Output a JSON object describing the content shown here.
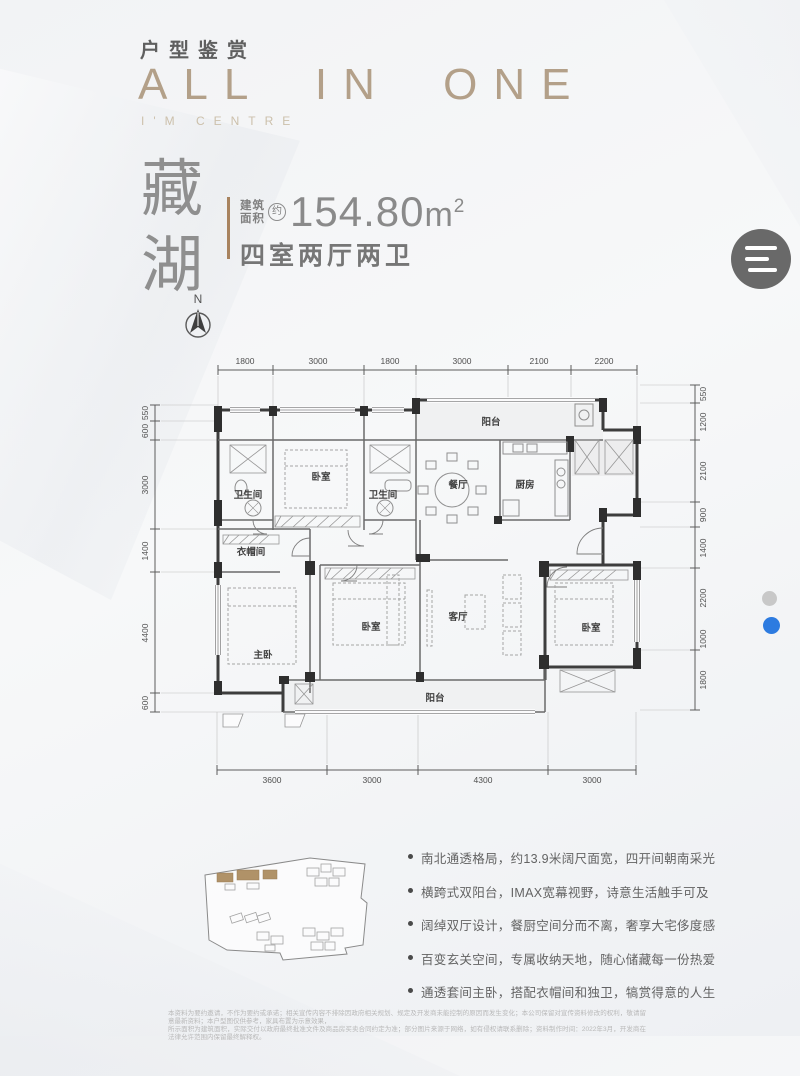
{
  "header": {
    "category": "户型鉴赏",
    "title": "ALL IN ONE",
    "subtitle": "I'M CENTRE"
  },
  "unit": {
    "name_char_1": "藏",
    "name_char_2": "湖",
    "compass_label": "N",
    "area_prefix_line1": "建筑",
    "area_prefix_line2": "面积",
    "area_approx": "约",
    "area_value": "154.80",
    "area_unit": "m",
    "area_exponent": "2",
    "layout_type": "四室两厅两卫"
  },
  "menu_button": {
    "icon": "hamburger-menu"
  },
  "pagination": {
    "dots": [
      {
        "state": "inactive",
        "color": "#c8c8c8"
      },
      {
        "state": "active",
        "color": "#2d7be0"
      }
    ]
  },
  "floor_plan": {
    "dims_top": [
      "1800",
      "3000",
      "1800",
      "3000",
      "2100",
      "2200"
    ],
    "dims_left": [
      "550",
      "600",
      "3000",
      "1400",
      "4400",
      "600"
    ],
    "dims_right": [
      "550",
      "1200",
      "2100",
      "900",
      "1400",
      "2200",
      "1000",
      "1800"
    ],
    "dims_bottom": [
      "3600",
      "3000",
      "4300",
      "3000"
    ],
    "rooms": {
      "bathroom1": "卫生间",
      "bedroom_top": "卧室",
      "bathroom2": "卫生间",
      "dining": "餐厅",
      "kitchen": "厨房",
      "balcony_top": "阳台",
      "cloakroom": "衣帽间",
      "master": "主卧",
      "bedroom_center": "卧室",
      "living": "客厅",
      "bedroom_right": "卧室",
      "balcony_bottom": "阳台"
    }
  },
  "site_plan": {
    "highlight_color": "#b09268"
  },
  "features": [
    "南北通透格局，约13.9米阔尺面宽，四开间朝南采光",
    "横跨式双阳台，IMAX宽幕视野，诗意生活触手可及",
    "阔绰双厅设计，餐厨空间分而不离，奢享大宅侈度感",
    "百变玄关空间，专属收纳天地，随心储藏每一份热爱",
    "通透套间主卧，搭配衣帽间和独卫，犒赏得意的人生"
  ],
  "disclaimer_line1": "本资料为要约邀请，不作为要约或承诺；相关宣传内容不排除因政府相关规划、规定及开发商未能控制的原因而发生变化；本公司保留对宣传资料修改的权利，敬请留意最新资料；本户型图仅供参考，家具布置为示意效果，",
  "disclaimer_line2": "所示面积为建筑面积，实际交付以政府最终批准文件及商品房买卖合同约定为准；部分图片来源于网络，如有侵权请联系删除；资料制作时间：2022年3月，开发商在法律允许范围内保留最终解释权。"
}
